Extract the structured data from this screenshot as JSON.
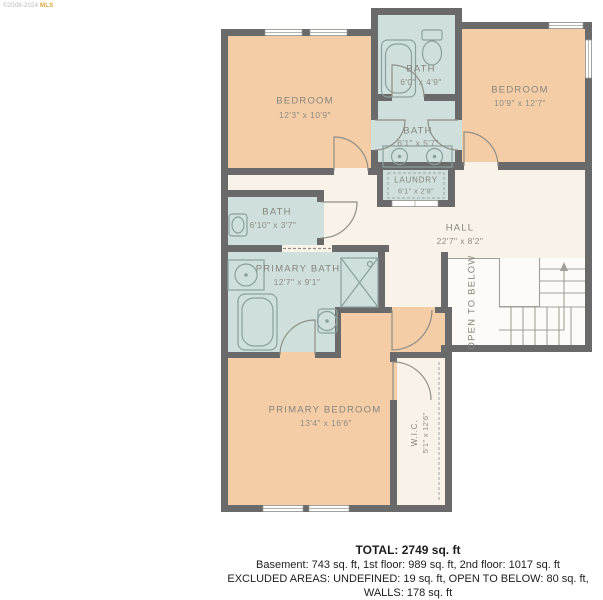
{
  "watermark": {
    "text": "©2008-2024",
    "suffix": "MLS"
  },
  "rooms": {
    "br1": {
      "name": "BEDROOM",
      "dims": "12'3\" x 10'9\""
    },
    "b1": {
      "name": "BATH",
      "dims": "6'0\" x 4'9\""
    },
    "br2": {
      "name": "BEDROOM",
      "dims": "10'9\" x 12'7\""
    },
    "b2": {
      "name": "BATH",
      "dims": "6'1\" x 5'7\""
    },
    "laundry": {
      "name": "LAUNDRY",
      "dims": "6'1\" x 2'8\""
    },
    "b3": {
      "name": "BATH",
      "dims": "6'10\" x 3'7\""
    },
    "hall": {
      "name": "HALL",
      "dims": "22'7\" x 8'2\""
    },
    "pb": {
      "name": "PRIMARY BATH",
      "dims": "12'7\" x 9'1\""
    },
    "otb": {
      "label": "OPEN TO BELOW"
    },
    "pbr": {
      "name": "PRIMARY BEDROOM",
      "dims": "13'4\" x 16'6\""
    },
    "wic": {
      "name": "W.I.C.",
      "dims": "5'1\" x 12'6\""
    }
  },
  "summary": {
    "total": "TOTAL: 2749 sq. ft",
    "floors": "Basement: 743 sq. ft, 1st floor: 989 sq. ft, 2nd floor: 1017 sq. ft",
    "excluded": "EXCLUDED AREAS: UNDEFINED: 19 sq. ft, OPEN TO BELOW: 80 sq. ft, WALLS: 178 sq. ft",
    "disclaimer": "FLOOR PLAN CREATED BY CUBICASA APP. MEASUREMENTS DEEMED HIGHLY RELIABLE BUT NOT GUARANTEED."
  },
  "colors": {
    "wall": "#6a6a6a",
    "bedroom_fill": "#f4cda6",
    "bath_fill": "#cfdfdc",
    "hall_fill": "#f9f2e9",
    "stairs_fill": "#fdfbf7",
    "accent_gold": "#d9a43e",
    "label_text": "#85857c"
  }
}
